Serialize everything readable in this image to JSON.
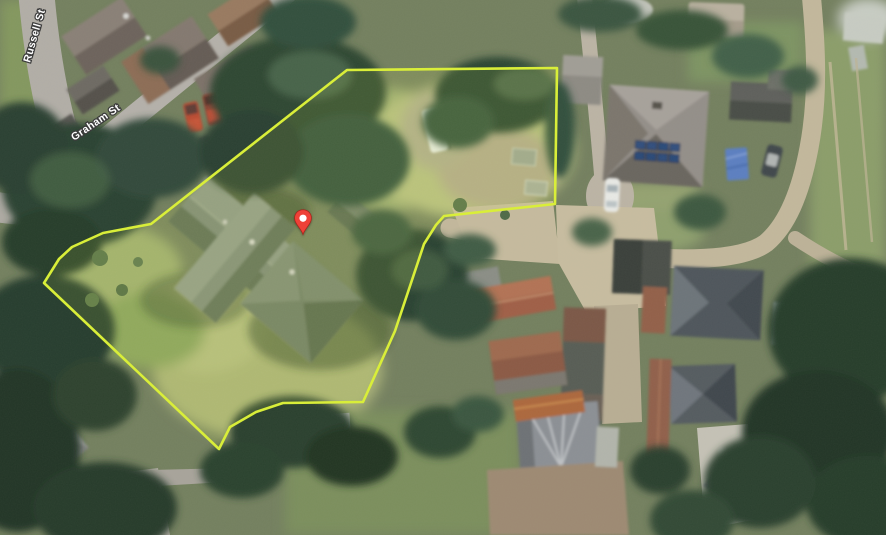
{
  "map": {
    "street_labels": [
      {
        "name": "Russell St"
      },
      {
        "name": "Graham St"
      }
    ],
    "property_boundary": {
      "points": "347,70 557,68 555,204 444,216 436,225 424,244 395,331 363,402 283,403 256,412 230,427 219,449 44,283 59,259 72,247 103,233 151,224",
      "stroke_color": "#d9ee39",
      "fill_color": "rgba(233,255,80,0.10)"
    },
    "marker": {
      "icon": "map-pin",
      "fill_color": "#ee4137",
      "outline_color": "#a8241c",
      "tip_x": 305,
      "tip_y": 236
    }
  }
}
